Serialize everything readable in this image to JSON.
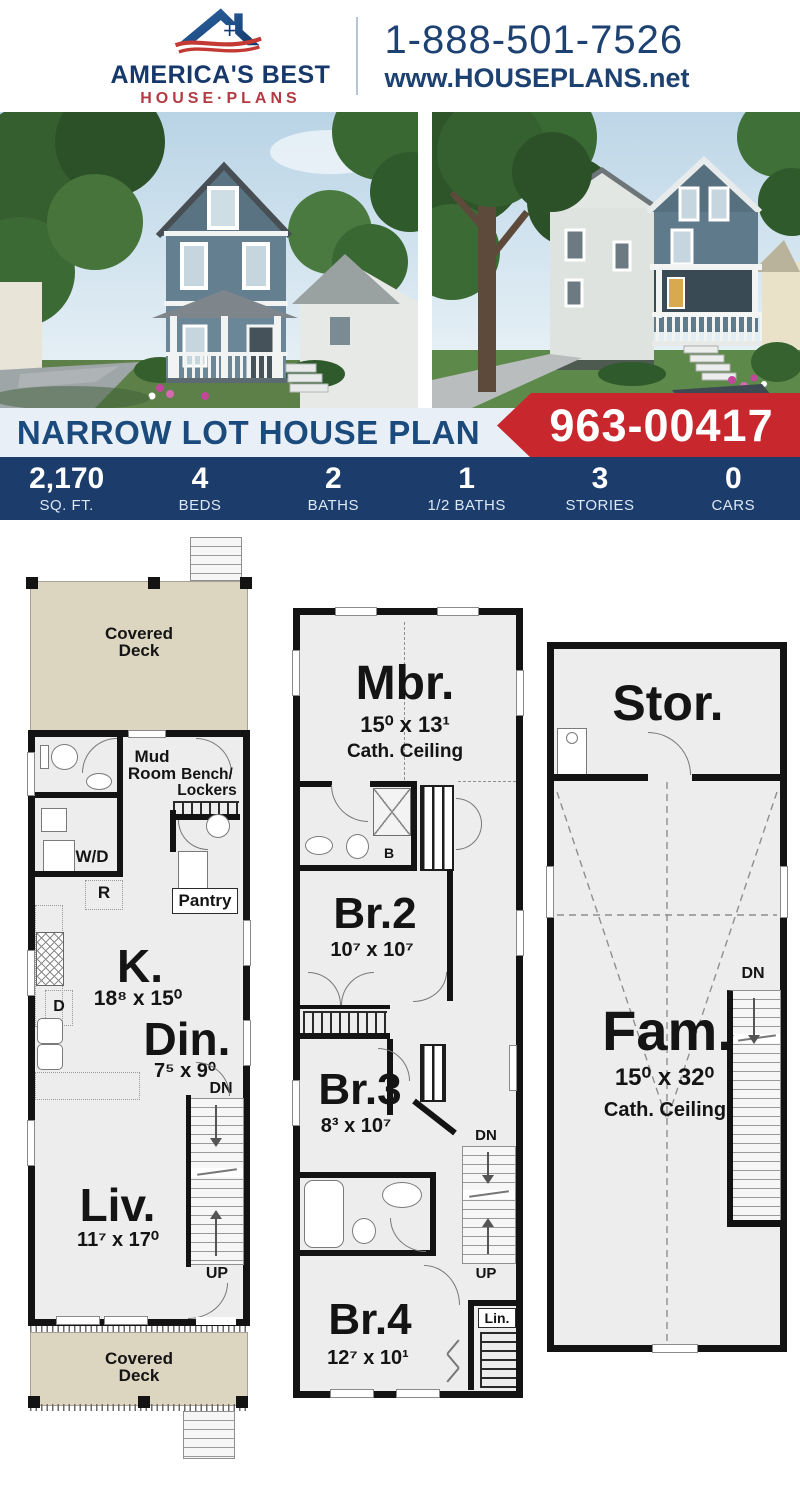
{
  "header": {
    "logo_line1": "AMERICA'S BEST",
    "logo_line2": "HOUSE·PLANS",
    "phone": "1-888-501-7526",
    "website": "www.HOUSEPLANS.net"
  },
  "banner": {
    "title": "NARROW LOT HOUSE PLAN",
    "plan_number": "963-00417"
  },
  "stats": [
    {
      "value": "2,170",
      "label": "SQ. FT."
    },
    {
      "value": "4",
      "label": "BEDS"
    },
    {
      "value": "2",
      "label": "BATHS"
    },
    {
      "value": "1",
      "label": "1/2 BATHS"
    },
    {
      "value": "3",
      "label": "STORIES"
    },
    {
      "value": "0",
      "label": "CARS"
    }
  ],
  "floors": {
    "first": {
      "deck_top": "Covered\nDeck",
      "mud_room": "Mud\nRoom",
      "bench_lockers": "Bench/\nLockers",
      "wd": "W/D",
      "r": "R",
      "pantry": "Pantry",
      "kitchen": "K.",
      "kitchen_dims": "18⁸ x 15⁰",
      "d": "D",
      "dining": "Din.",
      "dining_dims": "7⁵ x 9⁰",
      "dn": "DN",
      "up": "UP",
      "living": "Liv.",
      "living_dims": "11⁷ x 17⁰",
      "deck_bottom": "Covered\nDeck"
    },
    "second": {
      "master": "Mbr.",
      "master_dims": "15⁰ x 13¹",
      "master_ceiling": "Cath. Ceiling",
      "b": "B",
      "br2": "Br.2",
      "br2_dims": "10⁷ x 10⁷",
      "br3": "Br.3",
      "br3_dims": "8³ x 10⁷",
      "dn": "DN",
      "up": "UP",
      "br4": "Br.4",
      "br4_dims": "12⁷ x 10¹",
      "lin": "Lin."
    },
    "third": {
      "storage": "Stor.",
      "family": "Fam.",
      "family_dims": "15⁰ x 32⁰",
      "family_ceiling": "Cath. Ceiling",
      "dn": "DN"
    }
  },
  "icons": {
    "logo": "house-roof-swoosh-icon"
  },
  "colors": {
    "navy": "#1c3c6c",
    "red": "#c8272d",
    "banner_bg": "#e9eff6",
    "brand_navy": "#17386b",
    "brand_red": "#b43a42",
    "link_blue": "#1d4272",
    "deck_tan": "#dcd5c0",
    "wall_black": "#131313",
    "room_gray": "#ededed"
  }
}
